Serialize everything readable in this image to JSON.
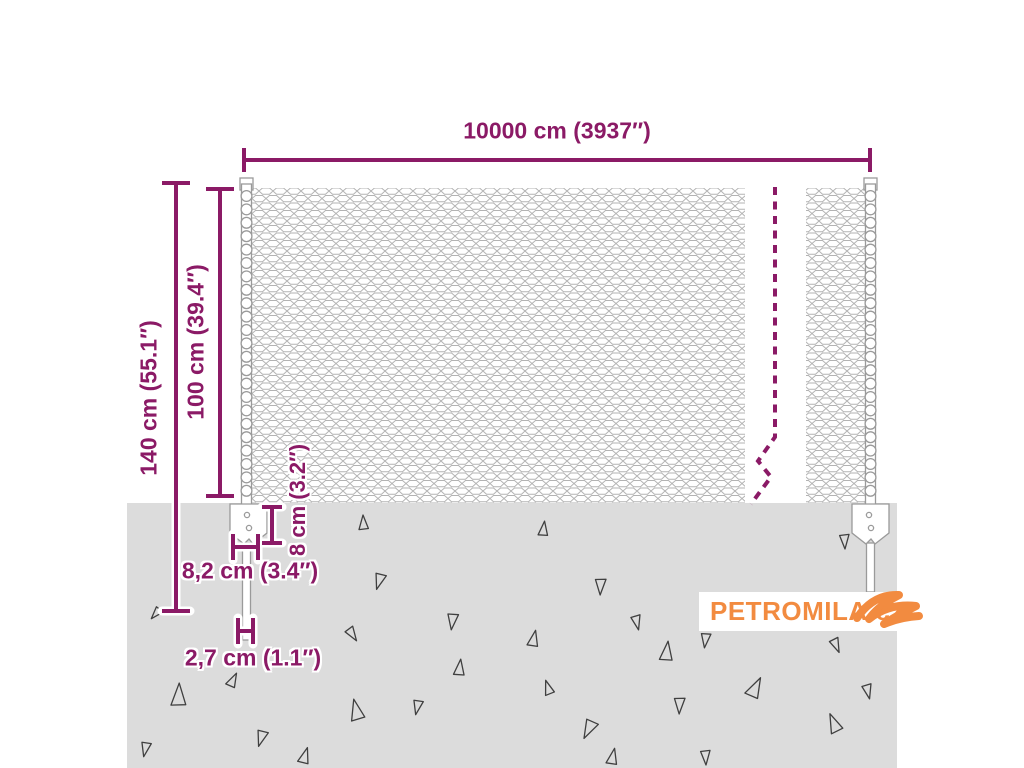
{
  "diagram": {
    "type": "product-dimension-diagram",
    "subject": "chain-link wire mesh fence with two posts, shown partly buried in ground"
  },
  "labels": {
    "total_width": "10000 cm (3937″)",
    "total_height": "140 cm (55.1″)",
    "mesh_height": "100 cm (39.4″)",
    "anchor_height": "8 cm (3.2″)",
    "anchor_width": "8,2 cm (3.4″)",
    "post_diameter": "2,7 cm (1.1″)"
  },
  "watermark": {
    "text": "PETROMILA.cz",
    "icon": "swoosh-icon"
  },
  "colors": {
    "purple": "#8b1a66",
    "orange": "#f28b40",
    "ground": "#dcdcdc",
    "mesh_wire": "#b3b3b3",
    "post_outline": "#9a9a9a",
    "triangle_outline": "#3f3f3f",
    "background": "#ffffff"
  },
  "ground": {
    "triangles": [
      {
        "x": 363,
        "y": 524,
        "s": 9,
        "r": 0
      },
      {
        "x": 543,
        "y": 530,
        "s": 9,
        "r": 10
      },
      {
        "x": 845,
        "y": 540,
        "s": 9,
        "r": 180
      },
      {
        "x": 380,
        "y": 580,
        "s": 10,
        "r": 200
      },
      {
        "x": 601,
        "y": 585,
        "s": 10,
        "r": 185
      },
      {
        "x": 157,
        "y": 613,
        "s": 8,
        "r": 225
      },
      {
        "x": 453,
        "y": 620,
        "s": 10,
        "r": 190
      },
      {
        "x": 352,
        "y": 633,
        "s": 9,
        "r": 150
      },
      {
        "x": 637,
        "y": 621,
        "s": 9,
        "r": 170
      },
      {
        "x": 533,
        "y": 640,
        "s": 10,
        "r": 15
      },
      {
        "x": 666,
        "y": 653,
        "s": 12,
        "r": 10
      },
      {
        "x": 706,
        "y": 639,
        "s": 9,
        "r": 190
      },
      {
        "x": 836,
        "y": 644,
        "s": 9,
        "r": 160
      },
      {
        "x": 178,
        "y": 697,
        "s": 14,
        "r": 5
      },
      {
        "x": 232,
        "y": 681,
        "s": 9,
        "r": 30
      },
      {
        "x": 146,
        "y": 748,
        "s": 9,
        "r": 195
      },
      {
        "x": 262,
        "y": 737,
        "s": 10,
        "r": 200
      },
      {
        "x": 356,
        "y": 712,
        "s": 13,
        "r": 350
      },
      {
        "x": 304,
        "y": 757,
        "s": 10,
        "r": 20
      },
      {
        "x": 418,
        "y": 706,
        "s": 9,
        "r": 195
      },
      {
        "x": 459,
        "y": 669,
        "s": 10,
        "r": 10
      },
      {
        "x": 590,
        "y": 728,
        "s": 12,
        "r": 210
      },
      {
        "x": 548,
        "y": 689,
        "s": 9,
        "r": 345
      },
      {
        "x": 612,
        "y": 758,
        "s": 10,
        "r": 15
      },
      {
        "x": 680,
        "y": 704,
        "s": 10,
        "r": 185
      },
      {
        "x": 754,
        "y": 689,
        "s": 13,
        "r": 30
      },
      {
        "x": 706,
        "y": 756,
        "s": 9,
        "r": 180
      },
      {
        "x": 834,
        "y": 725,
        "s": 12,
        "r": 340
      },
      {
        "x": 868,
        "y": 690,
        "s": 9,
        "r": 170
      }
    ]
  }
}
